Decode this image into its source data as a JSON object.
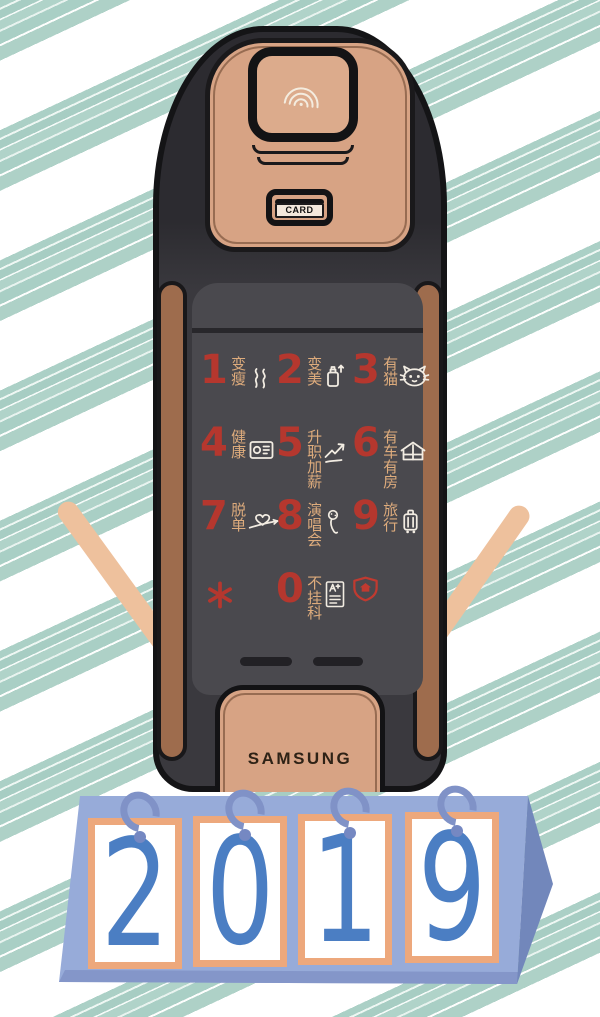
{
  "lock": {
    "brand": "SAMSUNG",
    "card_slot_label": "CARD",
    "fingerprint_icon": "fingerprint-icon",
    "keys": [
      {
        "num": "1",
        "label": "变瘦",
        "icon": "steam-icon"
      },
      {
        "num": "2",
        "label": "变美",
        "icon": "perfume-bottle-icon"
      },
      {
        "num": "3",
        "label": "有猫",
        "icon": "cat-icon"
      },
      {
        "num": "4",
        "label": "健康",
        "icon": "certificate-icon"
      },
      {
        "num": "5",
        "label": "升职加薪",
        "icon": "rising-chart-icon"
      },
      {
        "num": "6",
        "label": "有车有房",
        "icon": "house-car-icon"
      },
      {
        "num": "7",
        "label": "脱单",
        "icon": "heart-arrow-icon"
      },
      {
        "num": "8",
        "label": "演唱会",
        "icon": "microphone-icon"
      },
      {
        "num": "9",
        "label": "旅行",
        "icon": "suitcase-icon"
      },
      {
        "num": "*",
        "label": "",
        "icon": "asterisk-key-icon"
      },
      {
        "num": "0",
        "label": "不挂科",
        "icon": "exam-sheet-icon"
      },
      {
        "num": "",
        "label": "",
        "icon": "security-shield-icon"
      }
    ]
  },
  "calendar": {
    "year": "2019",
    "digits": [
      "2",
      "0",
      "1",
      "9"
    ]
  },
  "colors": {
    "background_stripe_teal": "#a9cfc5",
    "lock_body_dark": "#3a393e",
    "lock_tan": "#d7a384",
    "side_brown": "#9e6c4d",
    "key_number_red": "#b5372e",
    "key_label_tan": "#ddab7c",
    "key_icon_white": "#f2ece2",
    "calendar_blue": "#97abd9",
    "card_frame_orange": "#eda87c",
    "digit_blue": "#4b7ec3",
    "ring_blue": "#8092c7"
  }
}
